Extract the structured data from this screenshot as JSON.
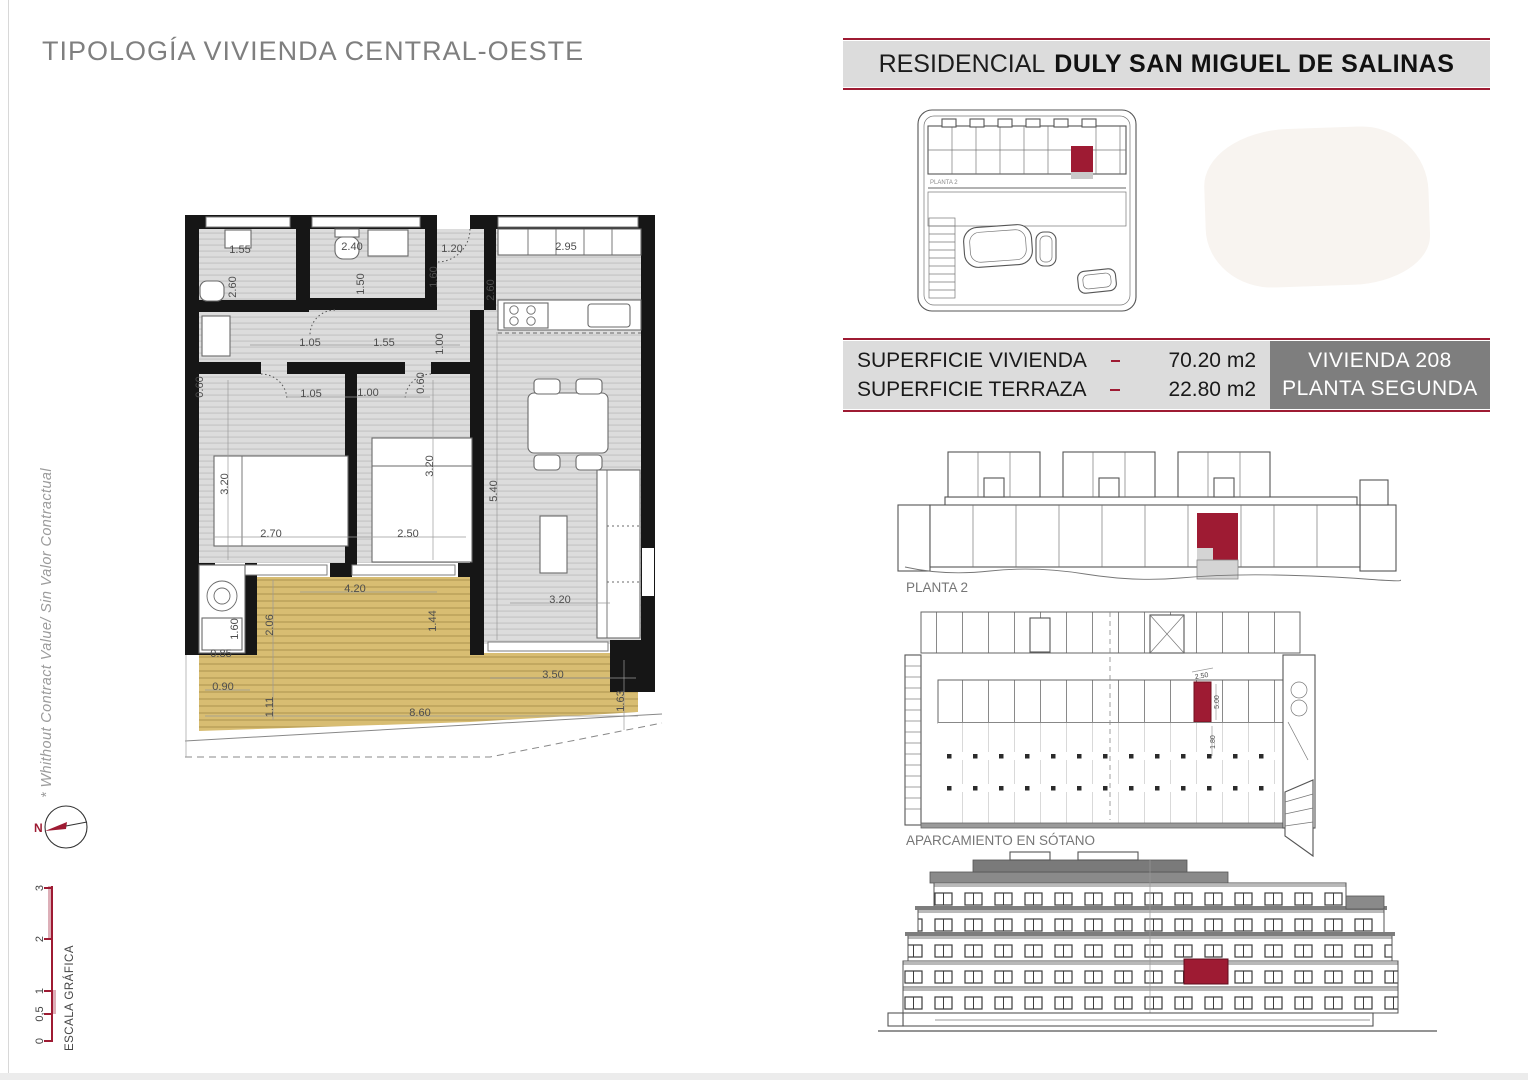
{
  "page": {
    "title": "TIPOLOGÍA VIVIENDA CENTRAL-OESTE",
    "side_note": "* Whithout Contract Value/ Sin Valor Contractual",
    "compass_label": "N",
    "scale": {
      "label": "ESCALA GRÁFICA",
      "ticks": [
        {
          "v": "3",
          "y": 888
        },
        {
          "v": "2",
          "y": 939
        },
        {
          "v": "1",
          "y": 991
        },
        {
          "v": "0,5",
          "y": 1014
        },
        {
          "v": "0",
          "y": 1041
        }
      ]
    }
  },
  "header": {
    "prefix": "RESIDENCIAL",
    "name": "DULY SAN MIGUEL DE SALINAS"
  },
  "info_panel": {
    "rows": [
      {
        "label": "SUPERFICIE VIVIENDA",
        "value": "70.20 m2"
      },
      {
        "label": "SUPERFICIE TERRAZA",
        "value": "22.80 m2"
      }
    ],
    "unit": {
      "line1": "VIVIENDA 208",
      "line2": "PLANTA SEGUNDA"
    }
  },
  "drawings": {
    "site_plan": {
      "label": "PLANTA 2"
    },
    "floor_elevation": {
      "label": "PLANTA 2"
    },
    "parking": {
      "label": "APARCAMIENTO EN SÓTANO",
      "dimensions": [
        {
          "v": "2.50",
          "x": 1202,
          "y": 678,
          "r": -10
        },
        {
          "v": "5.00",
          "x": 1219,
          "y": 702,
          "r": -90
        },
        {
          "v": "1.80",
          "x": 1215,
          "y": 742,
          "r": -90
        }
      ]
    },
    "floor_plan": {
      "dimensions": [
        {
          "v": "1.55",
          "x": 240,
          "y": 253,
          "r": 0
        },
        {
          "v": "2.40",
          "x": 352,
          "y": 250,
          "r": 0
        },
        {
          "v": "1.20",
          "x": 452,
          "y": 252,
          "r": 0
        },
        {
          "v": "2.95",
          "x": 566,
          "y": 250,
          "r": 0
        },
        {
          "v": "2.60",
          "x": 236,
          "y": 287,
          "r": -90
        },
        {
          "v": "1.50",
          "x": 364,
          "y": 284,
          "r": -90
        },
        {
          "v": "1.60",
          "x": 437,
          "y": 277,
          "r": -90
        },
        {
          "v": "2.60",
          "x": 494,
          "y": 290,
          "r": -90
        },
        {
          "v": "1.05",
          "x": 310,
          "y": 346,
          "r": 0
        },
        {
          "v": "1.55",
          "x": 384,
          "y": 346,
          "r": 0
        },
        {
          "v": "1.00",
          "x": 443,
          "y": 344,
          "r": -90
        },
        {
          "v": "0.60",
          "x": 203,
          "y": 387,
          "r": -90
        },
        {
          "v": "1.05",
          "x": 311,
          "y": 397,
          "r": 0
        },
        {
          "v": "1.00",
          "x": 368,
          "y": 396,
          "r": 0
        },
        {
          "v": "0.60",
          "x": 424,
          "y": 383,
          "r": -90
        },
        {
          "v": "3.20",
          "x": 228,
          "y": 484,
          "r": -90
        },
        {
          "v": "3.20",
          "x": 433,
          "y": 466,
          "r": -90
        },
        {
          "v": "5.40",
          "x": 497,
          "y": 491,
          "r": -90
        },
        {
          "v": "2.70",
          "x": 271,
          "y": 537,
          "r": 0
        },
        {
          "v": "2.50",
          "x": 408,
          "y": 537,
          "r": 0
        },
        {
          "v": "4.20",
          "x": 355,
          "y": 592,
          "r": 0
        },
        {
          "v": "1.60",
          "x": 238,
          "y": 629,
          "r": -90
        },
        {
          "v": "2.06",
          "x": 273,
          "y": 625,
          "r": -90
        },
        {
          "v": "1.44",
          "x": 436,
          "y": 621,
          "r": -90
        },
        {
          "v": "0.85",
          "x": 221,
          "y": 657,
          "r": 0
        },
        {
          "v": "3.20",
          "x": 560,
          "y": 603,
          "r": 0
        },
        {
          "v": "0.90",
          "x": 223,
          "y": 690,
          "r": 0
        },
        {
          "v": "1.11",
          "x": 273,
          "y": 707,
          "r": -90
        },
        {
          "v": "8.60",
          "x": 420,
          "y": 716,
          "r": 0
        },
        {
          "v": "3.50",
          "x": 553,
          "y": 678,
          "r": 0
        },
        {
          "v": "1.63",
          "x": 624,
          "y": 701,
          "r": -90
        }
      ]
    }
  },
  "colors": {
    "accent": "#9e1b33",
    "terrace_fill": "#d8bd72",
    "panel_light": "#dcdcdc",
    "panel_dark": "#7e7e7e"
  }
}
